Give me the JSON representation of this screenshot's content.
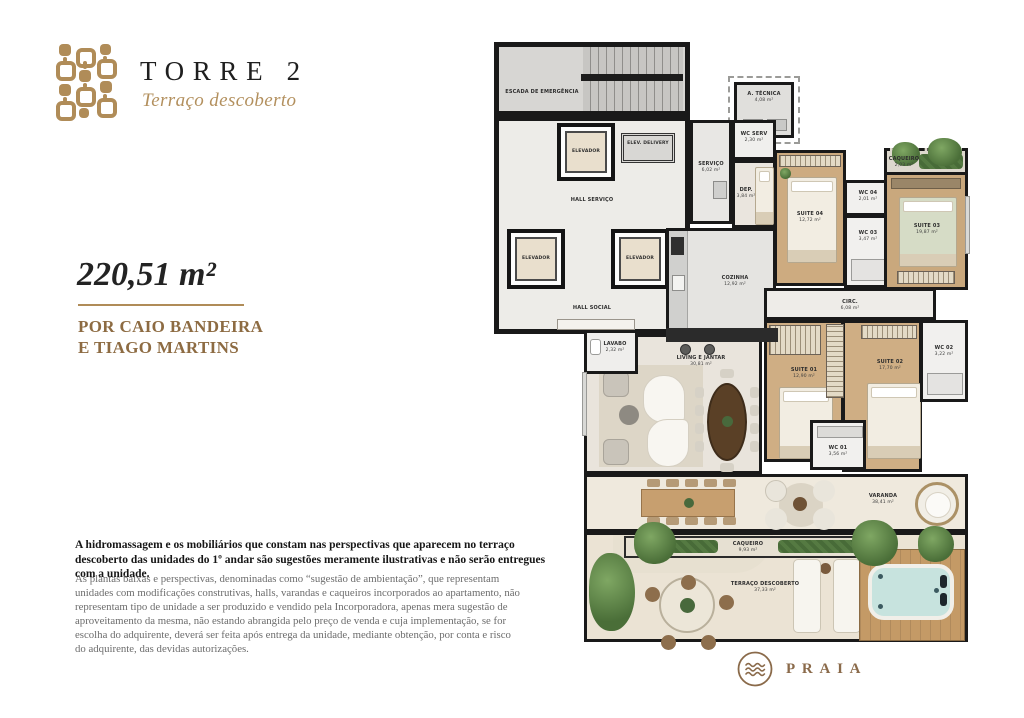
{
  "header": {
    "title": "TORRE 2",
    "subtitle": "Terraço descoberto"
  },
  "unit": {
    "area": "220,51 m²",
    "author_line1": "POR CAIO BANDEIRA",
    "author_line2": "E TIAGO MARTINS"
  },
  "disclaimer": {
    "bold": "A hidromassagem e os mobiliários que constam nas perspectivas que aparecem no terraço descoberto das unidades do 1º andar são sugestões meramente ilustrativas e não serão entregues com a unidade.",
    "body": "As plantas baixas e perspectivas, denominadas como “sugestão de ambientação”, que representam unidades com modificações construtivas, halls, varandas e caqueiros incorporados ao apartamento, não representam tipo de unidade a ser produzido e vendido pela Incorporadora, apenas mera sugestão de aproveitamento da mesma, não estando abrangida pelo preço de venda e cuja implementação, se for escolha do adquirente, deverá ser feita após entrega da unidade, mediante obtenção, por conta e risco do adquirente, das devidas autorizações."
  },
  "brand": {
    "name": "PRAIA"
  },
  "colors": {
    "gold": "#b08c58",
    "brown": "#8d6b42",
    "wall": "#191919"
  },
  "floorplan": {
    "rooms": {
      "escada": {
        "label": "ESCADA DE EMERGÊNCIA",
        "area": ""
      },
      "a_tecnica": {
        "label": "A. TÉCNICA",
        "area": "4,08 m²"
      },
      "elevador_top": {
        "label": "ELEVADOR",
        "area": ""
      },
      "elev_delivery": {
        "label": "ELEV. DELIVERY",
        "area": ""
      },
      "servico": {
        "label": "SERVIÇO",
        "area": "6,02 m²"
      },
      "wc_serv": {
        "label": "WC SERV",
        "area": "2,30 m²"
      },
      "dep": {
        "label": "DEP.",
        "area": "3,84 m²"
      },
      "hall_servico": {
        "label": "HALL SERVIÇO",
        "area": ""
      },
      "hall_social": {
        "label": "HALL SOCIAL",
        "area": ""
      },
      "elevador_left": {
        "label": "ELEVADOR",
        "area": ""
      },
      "elevador_right": {
        "label": "ELEVADOR",
        "area": ""
      },
      "cozinha": {
        "label": "COZINHA",
        "area": "12,92 m²"
      },
      "suite04": {
        "label": "SUITE 04",
        "area": "12,72 m²"
      },
      "wc04": {
        "label": "WC 04",
        "area": "2,01 m²"
      },
      "wc03": {
        "label": "WC 03",
        "area": "3,47 m²"
      },
      "caqueiro_top": {
        "label": "CAQUEIRO",
        "area": "2,03 m²"
      },
      "suite03": {
        "label": "SUITE 03",
        "area": "19,87 m²"
      },
      "circ": {
        "label": "CIRC.",
        "area": "6,08 m²"
      },
      "lavabo": {
        "label": "LAVABO",
        "area": "2,32 m²"
      },
      "living": {
        "label": "LIVING E JANTAR",
        "area": "30,81 m²"
      },
      "suite01": {
        "label": "SUITE 01",
        "area": "12,90 m²"
      },
      "suite02": {
        "label": "SUITE 02",
        "area": "17,70 m²"
      },
      "wc02": {
        "label": "WC 02",
        "area": "3,22 m²"
      },
      "wc01": {
        "label": "WC 01",
        "area": "3,56 m²"
      },
      "varanda": {
        "label": "VARANDA",
        "area": "38,41 m²"
      },
      "caqueiro": {
        "label": "CAQUEIRO",
        "area": "9,93 m²"
      },
      "terraco": {
        "label": "TERRAÇO DESCOBERTO",
        "area": "37,33 m²"
      }
    }
  }
}
